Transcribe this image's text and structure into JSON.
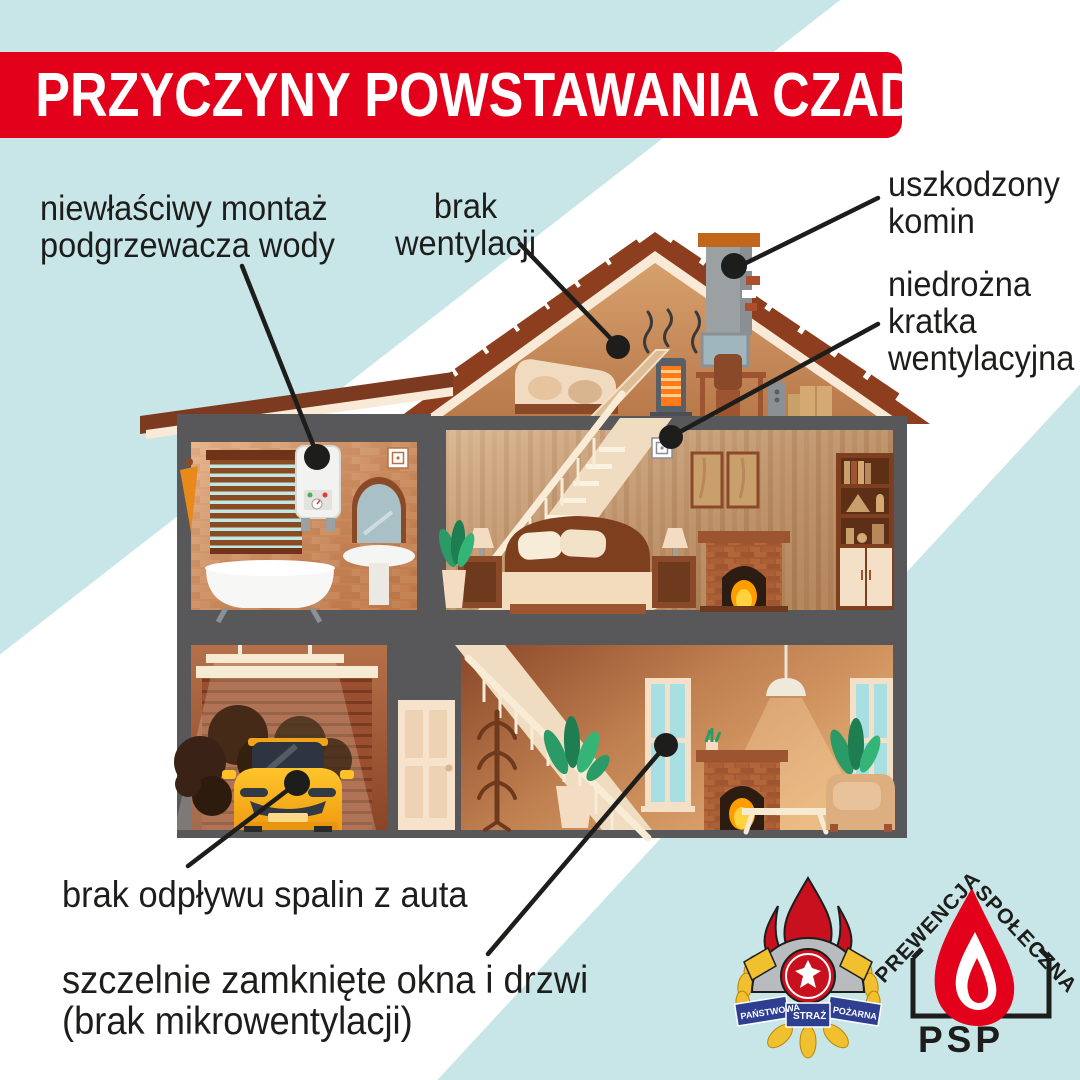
{
  "title": "PRZYCZYNY POWSTAWANIA CZADU",
  "callouts": {
    "water_heater": [
      "niewłaściwy montaż",
      "podgrzewacza wody"
    ],
    "ventilation": [
      "brak",
      "wentylacji"
    ],
    "chimney": [
      "uszkodzony",
      "komin"
    ],
    "vent_grille": [
      "niedrożna",
      "kratka",
      "wentylacyjna"
    ],
    "car_exhaust": [
      "brak odpływu spalin z auta"
    ],
    "windows": [
      "szczelnie zamknięte okna i drzwi",
      "(brak mikrowentylacji)"
    ]
  },
  "logos": {
    "psp_crest_ribbon": [
      "PAŃSTWOWA",
      "STRAŻ",
      "POŻARNA"
    ],
    "prevention": [
      "PREWENCJA",
      "SPOŁECZNA",
      "PSP"
    ]
  },
  "colors": {
    "banner_red": "#e2001a",
    "background_blue": "#c8e6e8",
    "text_dark": "#1d1d1b",
    "callout_line": "#1d1d1b",
    "wall_gray": "#58585a",
    "roof_brown": "#8c3e1e",
    "flame_red": "#e2001a",
    "ribbon_blue": "#2e3f92",
    "laurel_yellow": "#f0c02e",
    "car_yellow": "#f5a81c",
    "window_teal": "#a7dfe2"
  }
}
